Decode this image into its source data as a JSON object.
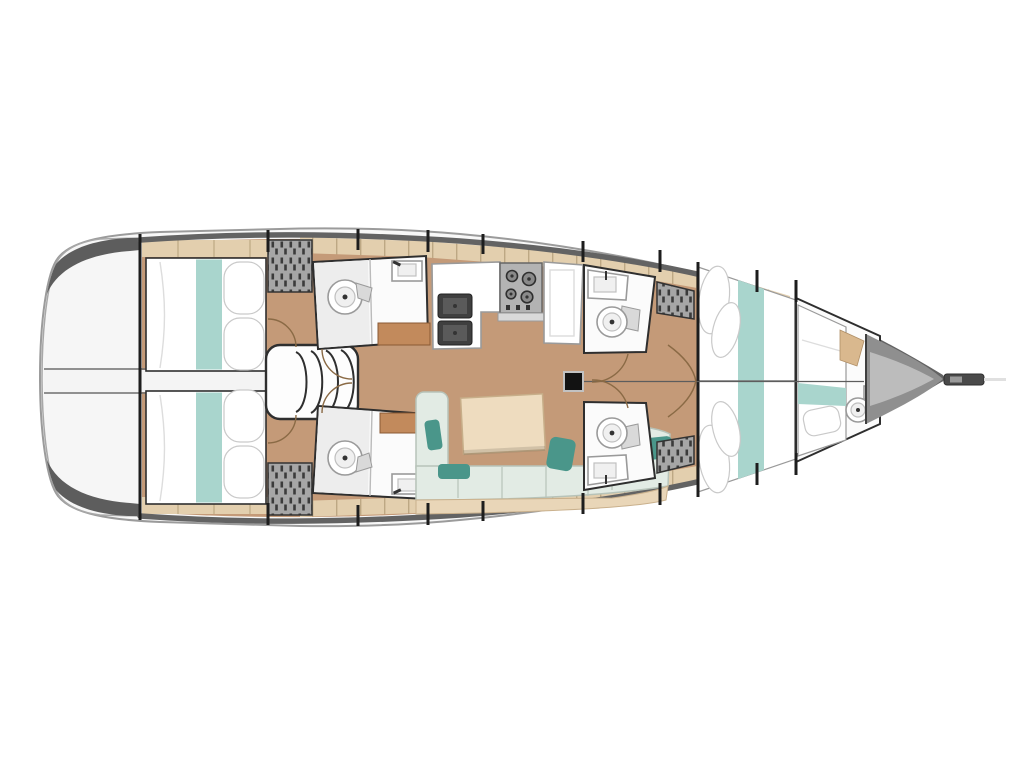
{
  "page": {
    "title": "Sailing yacht interior accommodation plan, top view with bow to the right",
    "background": "#ffffff"
  },
  "palette": {
    "page_bg": "#ffffff",
    "hull_outline": "#9b9b9b",
    "hull_band": "#636363",
    "deck_white": "#f8f8f8",
    "bow_gray": "#8f8f8f",
    "floor_wood": "#c49a78",
    "shelf_tan": "#e3cfae",
    "shelf_line": "#bda884",
    "wood_accent": "#c28a5c",
    "furniture_white": "#fbfbfb",
    "room_outline": "#2e2e2e",
    "bed_teal": "#a9d5cd",
    "pillow_teal": "#4a968a",
    "sofa_pale": "#e2ebe4",
    "sofa_line": "#b7c3b9",
    "table_tan": "#eedcbf",
    "locker_gray": "#a6a6a6",
    "locker_hatch": "#3b3b3b",
    "stove_gray": "#b3b3b3",
    "sink_dark": "#3f3f3f",
    "door_arc": "#8a6a45",
    "mast_black": "#121212"
  },
  "diagram": {
    "type": "floorplan",
    "subject": "monohull sailing yacht accommodation layout seen from above",
    "orientation": "bow-right-stern-left",
    "rooms": [
      {
        "id": "swim-platform",
        "label": "stern transom / swim platform"
      },
      {
        "id": "aft-cabin-top",
        "label": "aft double cabin, port side"
      },
      {
        "id": "aft-cabin-bottom",
        "label": "aft double cabin, starboard side"
      },
      {
        "id": "companionway",
        "label": "companionway steps between aft cabins"
      },
      {
        "id": "aft-head-top",
        "label": "aft bathroom with toilet and washbasin, port"
      },
      {
        "id": "aft-head-bottom",
        "label": "aft bathroom with toilet and washbasin, starboard"
      },
      {
        "id": "galley",
        "label": "galley with double sink and stove"
      },
      {
        "id": "salon",
        "label": "salon with L-shaped sofa and table"
      },
      {
        "id": "mid-head-top",
        "label": "forward bathroom with toilet and washbasin, port"
      },
      {
        "id": "mid-head-bottom",
        "label": "forward bathroom with toilet and washbasin, starboard"
      },
      {
        "id": "forward-cabin",
        "label": "forward double cabin with island berth"
      },
      {
        "id": "forepeak-cabin",
        "label": "bow cabin with berth and small toilet room"
      },
      {
        "id": "anchor-locker",
        "label": "bow anchor locker"
      }
    ],
    "fixtures": [
      {
        "name": "double-berth",
        "count": 3
      },
      {
        "name": "single-berth",
        "count": 1
      },
      {
        "name": "toilet",
        "count": 5
      },
      {
        "name": "washbasin",
        "count": 5
      },
      {
        "name": "galley-double-sink",
        "count": 1
      },
      {
        "name": "stove",
        "count": 1
      },
      {
        "name": "companionway-stairs",
        "count": 1
      },
      {
        "name": "sofa",
        "count": 1
      },
      {
        "name": "salon-table",
        "count": 1
      },
      {
        "name": "mast-foot",
        "count": 1
      },
      {
        "name": "slatted-locker",
        "count": 4
      },
      {
        "name": "door-swing-arc",
        "count": 8
      },
      {
        "name": "bowsprit",
        "count": 1
      }
    ]
  }
}
